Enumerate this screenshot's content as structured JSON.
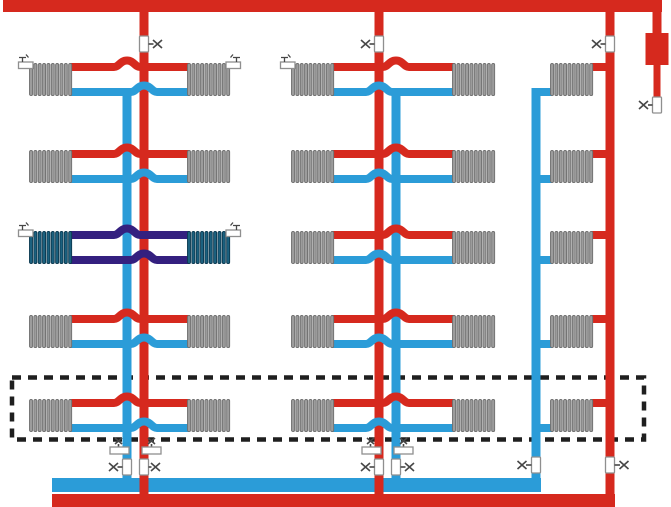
{
  "title": "Two-pipe heating system riser scheme with top air line and expansion tank",
  "colors": {
    "bg": "#ffffff",
    "supply": "#d6291e",
    "return": "#2b9cd8",
    "cold_pipe": "#34207f",
    "cold_fin": "#1b617f",
    "cold_fin_edge": "#0c3950",
    "fin": "#9c9c9c",
    "fin_edge": "#6f6f6f",
    "valve_fill": "#ffffff",
    "valve_stroke": "#8f8f8f",
    "symbol": "#474747",
    "dash": "#1f1f1f"
  },
  "structure": {
    "floors": 5,
    "riser_groups": 3,
    "radiators_total": 25,
    "cold_radiators": 2,
    "cold_floor": 3,
    "cold_riser_group": 1,
    "expansion_tank": 1,
    "riser_shutoff_valves_top": 3,
    "riser_shutoff_valves_bottom": 6,
    "drain_unions": 4,
    "air_vent_fittings": 5,
    "first_floor_outlined_dashed": true
  },
  "legend": {
    "red_pipes": "supply (hot) mains and risers",
    "blue_pipes": "return (cooled) mains and risers",
    "dark_purple_pipes": "cold branch pipes of third floor, left riser",
    "dark_teal_radiators": "cold radiators on third floor, left riser",
    "gray_coils": "radiators",
    "white_rectangles": "shut-off / drain valves",
    "x_symbols": "valve handles",
    "dashed_rectangle": "first floor zone"
  }
}
